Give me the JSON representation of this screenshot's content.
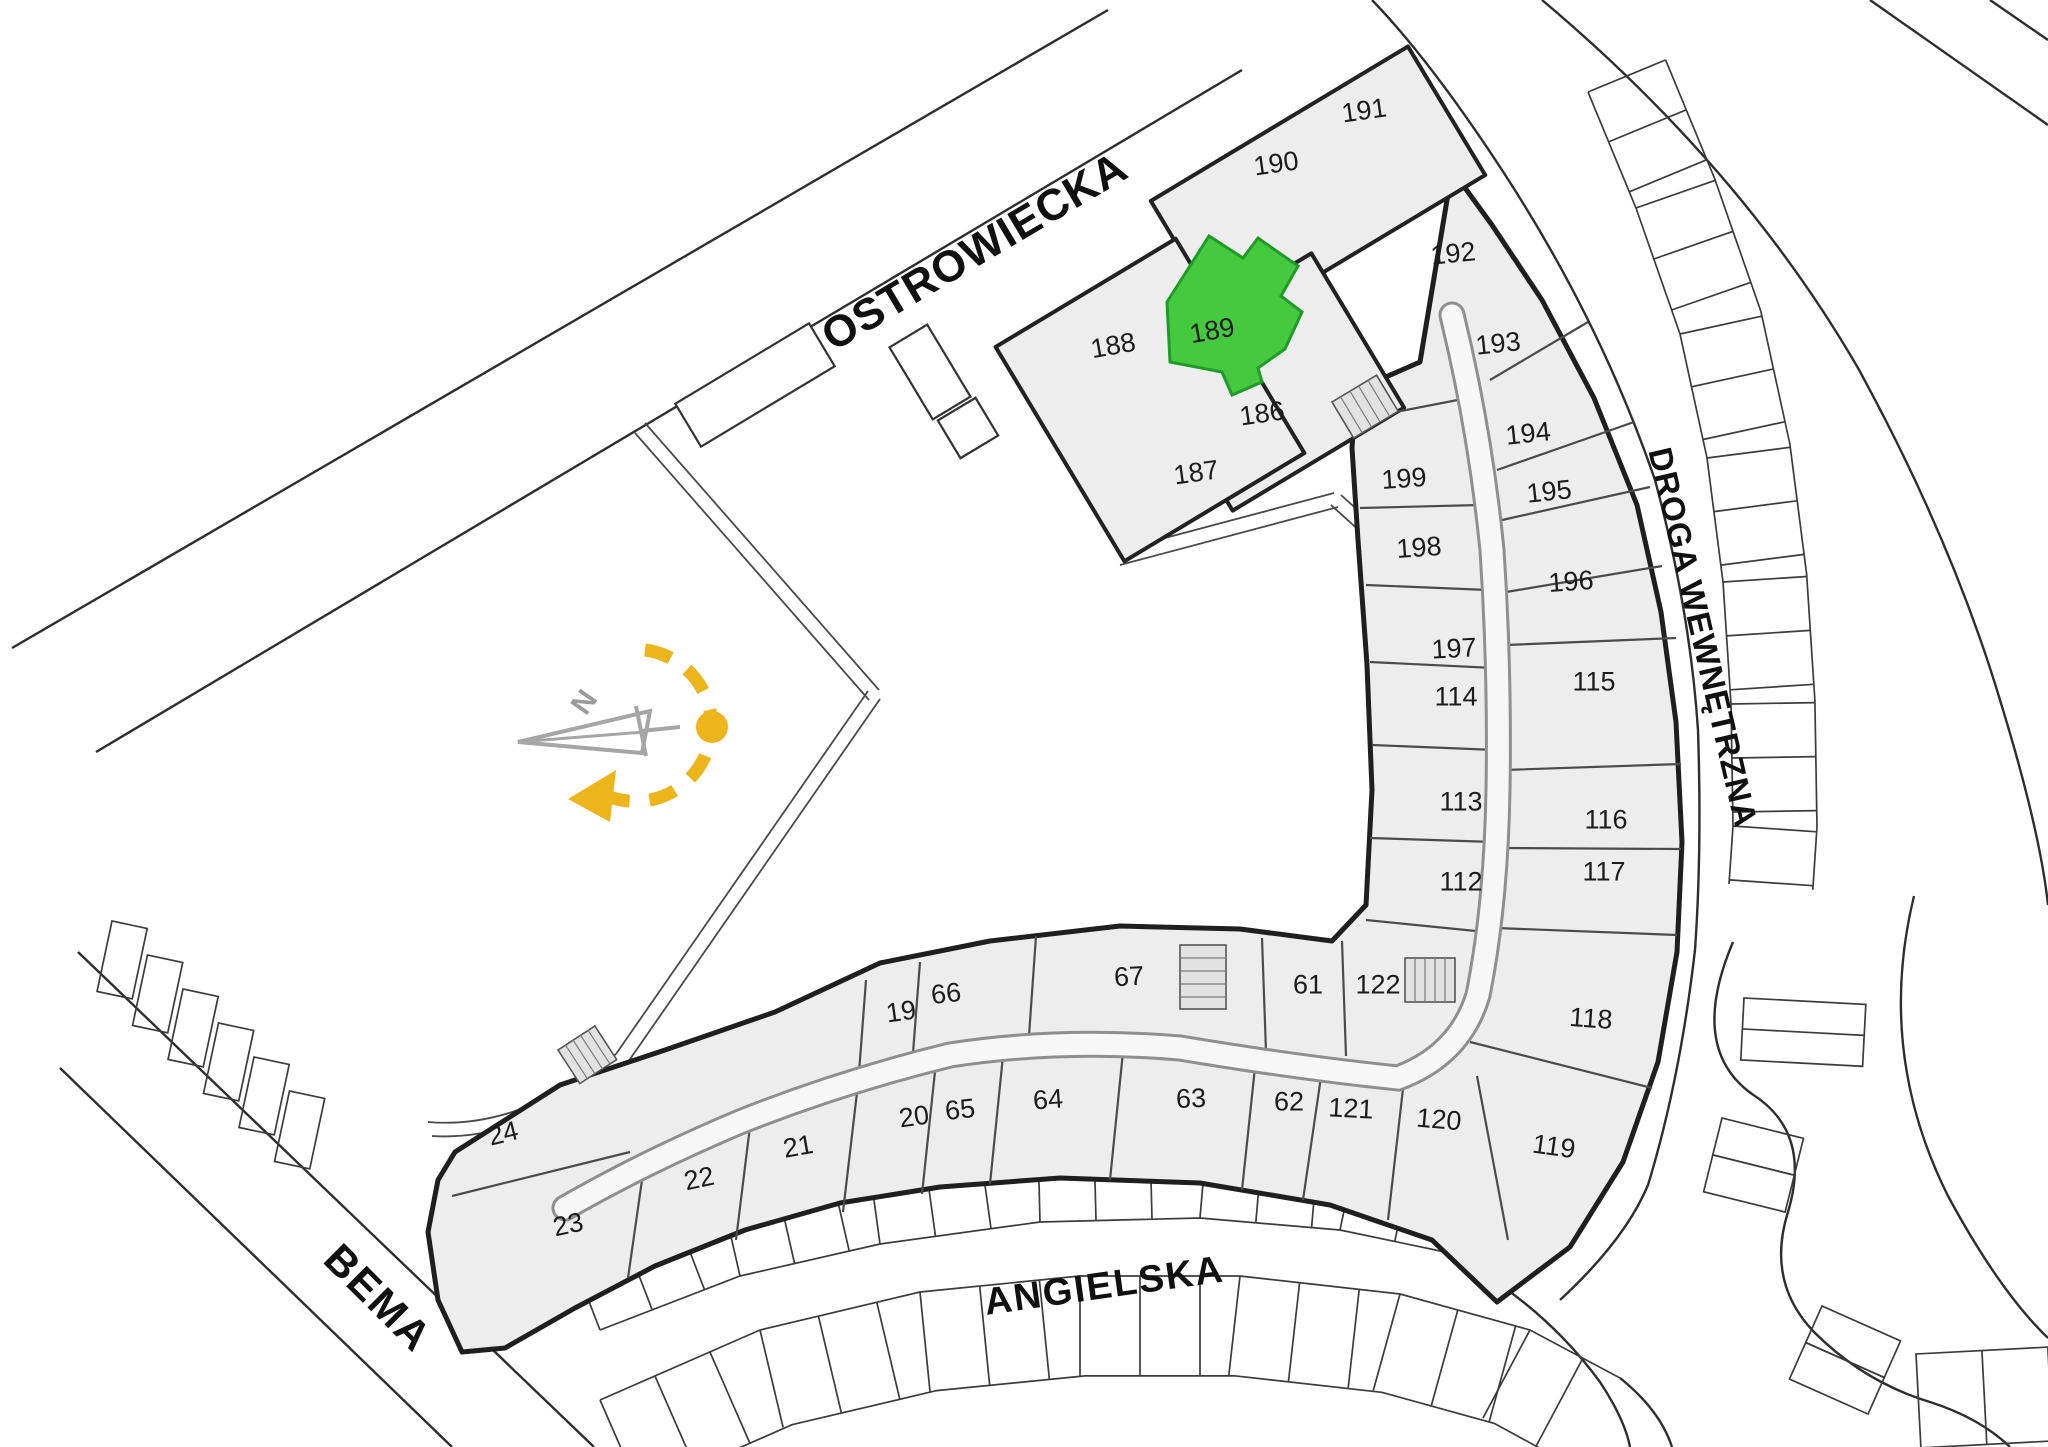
{
  "plan": {
    "colors": {
      "highlight_fill": "#45c93e",
      "highlight_stroke": "#1f9c28",
      "accent_yellow": "#ecb51c",
      "building_fill": "#ededed",
      "line_dark": "#1f1f1f"
    },
    "compass": {
      "north_letter": "N"
    },
    "streets": [
      {
        "name": "OSTROWIECKA",
        "x": 982,
        "y": 264,
        "rot": -30.6,
        "size": 44,
        "ls": 1
      },
      {
        "name": "DROGA WEWNĘTRZNA",
        "x": 1692,
        "y": 640,
        "rot": 77,
        "size": 33,
        "ls": 1
      },
      {
        "name": "ANGIELSKA",
        "x": 1106,
        "y": 1298,
        "rot": -8,
        "size": 38,
        "ls": 2
      },
      {
        "name": "BEMA",
        "x": 368,
        "y": 1308,
        "rot": 45,
        "size": 42,
        "ls": 2
      }
    ],
    "highlighted_unit": {
      "no": "189",
      "x": 1212,
      "y": 330,
      "rot": -10
    },
    "units": [
      {
        "no": "188",
        "x": 1113,
        "y": 345,
        "rot": -10
      },
      {
        "no": "190",
        "x": 1276,
        "y": 163,
        "rot": -8
      },
      {
        "no": "191",
        "x": 1364,
        "y": 110,
        "rot": -8
      },
      {
        "no": "186",
        "x": 1262,
        "y": 413,
        "rot": -8
      },
      {
        "no": "187",
        "x": 1196,
        "y": 472,
        "rot": -8
      },
      {
        "no": "192",
        "x": 1453,
        "y": 253,
        "rot": -6
      },
      {
        "no": "193",
        "x": 1498,
        "y": 343,
        "rot": -6
      },
      {
        "no": "194",
        "x": 1528,
        "y": 433,
        "rot": -6
      },
      {
        "no": "195",
        "x": 1549,
        "y": 491,
        "rot": -6
      },
      {
        "no": "196",
        "x": 1571,
        "y": 581,
        "rot": -4
      },
      {
        "no": "199",
        "x": 1404,
        "y": 478,
        "rot": -4
      },
      {
        "no": "198",
        "x": 1419,
        "y": 547,
        "rot": -4
      },
      {
        "no": "197",
        "x": 1454,
        "y": 648,
        "rot": -3
      },
      {
        "no": "114",
        "x": 1456,
        "y": 696,
        "rot": 0
      },
      {
        "no": "115",
        "x": 1594,
        "y": 681,
        "rot": 0
      },
      {
        "no": "113",
        "x": 1461,
        "y": 801,
        "rot": 0
      },
      {
        "no": "116",
        "x": 1606,
        "y": 819,
        "rot": 0
      },
      {
        "no": "112",
        "x": 1461,
        "y": 881,
        "rot": 0
      },
      {
        "no": "117",
        "x": 1604,
        "y": 871,
        "rot": 0
      },
      {
        "no": "118",
        "x": 1591,
        "y": 1018,
        "rot": 4
      },
      {
        "no": "61",
        "x": 1308,
        "y": 984,
        "rot": 0
      },
      {
        "no": "122",
        "x": 1378,
        "y": 984,
        "rot": 0
      },
      {
        "no": "62",
        "x": 1289,
        "y": 1101,
        "rot": 0
      },
      {
        "no": "121",
        "x": 1351,
        "y": 1108,
        "rot": 3
      },
      {
        "no": "120",
        "x": 1439,
        "y": 1119,
        "rot": 5
      },
      {
        "no": "119",
        "x": 1554,
        "y": 1146,
        "rot": 8
      },
      {
        "no": "67",
        "x": 1129,
        "y": 976,
        "rot": -3
      },
      {
        "no": "66",
        "x": 946,
        "y": 993,
        "rot": -6
      },
      {
        "no": "19",
        "x": 901,
        "y": 1011,
        "rot": -8
      },
      {
        "no": "65",
        "x": 960,
        "y": 1109,
        "rot": -6
      },
      {
        "no": "64",
        "x": 1048,
        "y": 1099,
        "rot": -4
      },
      {
        "no": "63",
        "x": 1191,
        "y": 1098,
        "rot": -2
      },
      {
        "no": "20",
        "x": 914,
        "y": 1116,
        "rot": -8
      },
      {
        "no": "21",
        "x": 798,
        "y": 1146,
        "rot": -10
      },
      {
        "no": "22",
        "x": 699,
        "y": 1178,
        "rot": -12
      },
      {
        "no": "24",
        "x": 503,
        "y": 1133,
        "rot": -14
      },
      {
        "no": "23",
        "x": 568,
        "y": 1224,
        "rot": -12
      }
    ]
  }
}
